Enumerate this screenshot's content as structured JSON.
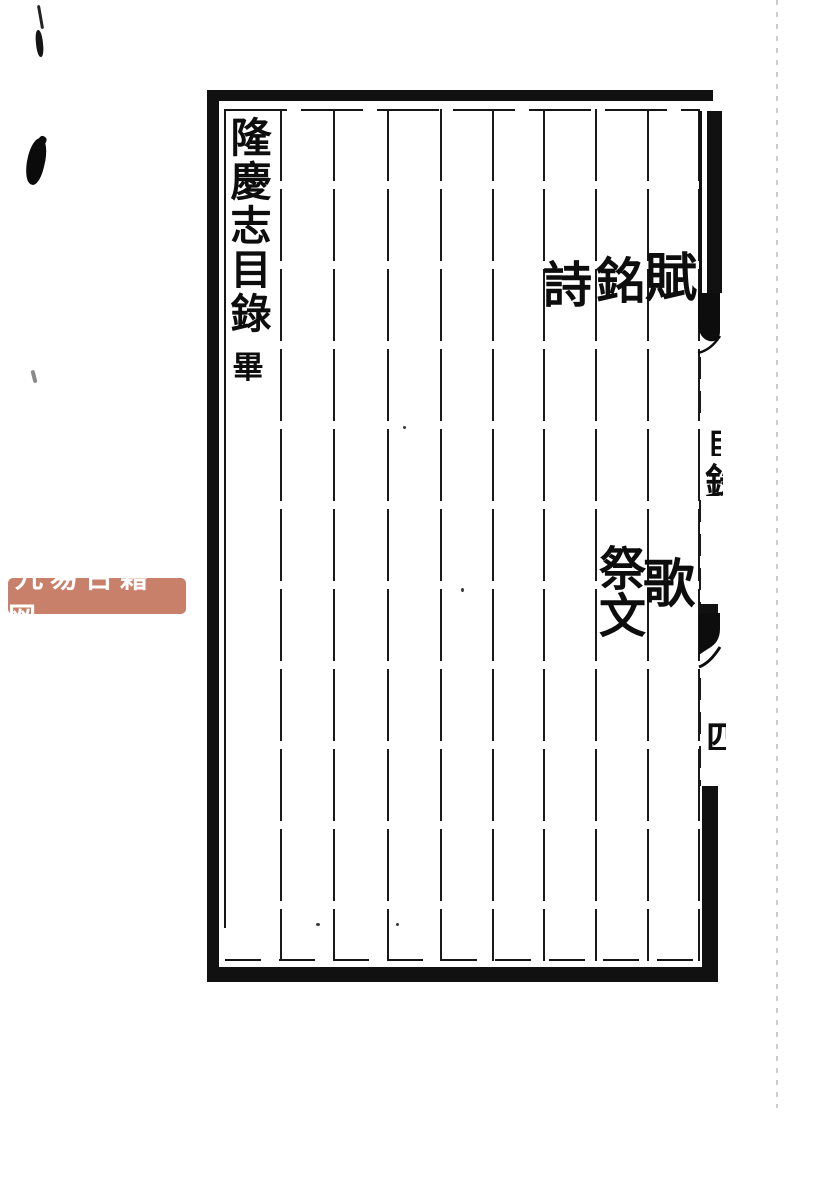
{
  "document": {
    "type": "woodblock-printed Chinese book page (scan)",
    "ink_color": "#111111",
    "paper_color": "#ffffff"
  },
  "watermark": {
    "text": "九易古籍网",
    "bg_color": "#c8806a",
    "text_color": "#ffffff"
  },
  "page": {
    "title_column": {
      "text": "隆慶志目錄",
      "end_mark": "畢"
    },
    "entries": [
      {
        "id": "fu",
        "text": "賦"
      },
      {
        "id": "ming",
        "text": "銘"
      },
      {
        "id": "shi",
        "text": "詩"
      },
      {
        "id": "ge",
        "text": "歌"
      },
      {
        "id": "jiwen",
        "text": "祭文"
      }
    ],
    "spine": {
      "partial_top": "目",
      "partial_mid": "錄",
      "page_number_partial": "四"
    }
  }
}
